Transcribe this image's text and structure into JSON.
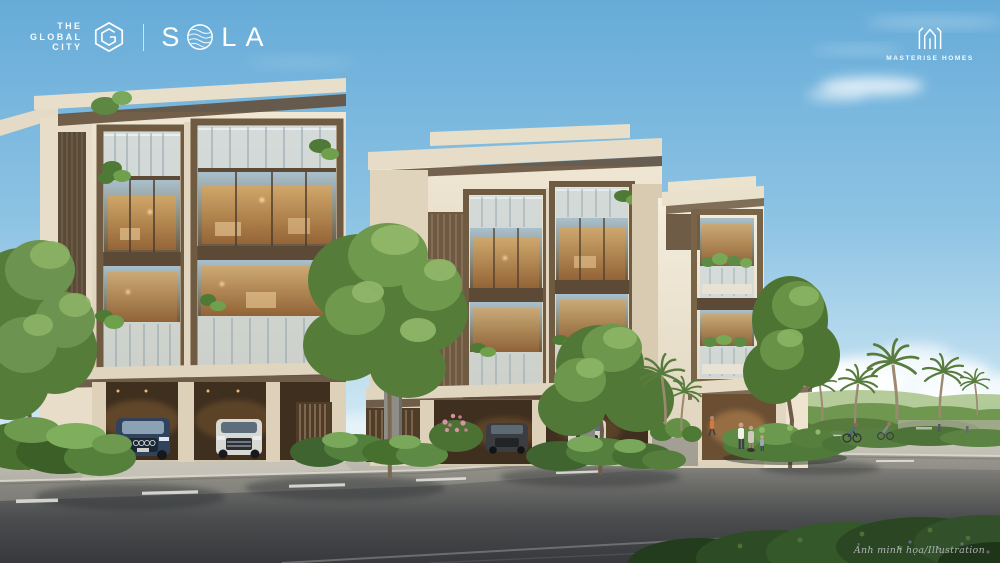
{
  "branding": {
    "global_city": {
      "line1": "THE",
      "line2": "GLOBAL",
      "line3": "CITY"
    },
    "sola": {
      "first": "S",
      "rest": "LA"
    },
    "developer": "MASTERISE HOMES"
  },
  "caption": "Ảnh minh họa/Illustration",
  "icons": {
    "global_city_hexagon": "hexagon-g-icon",
    "sola_o": "wave-circle-icon",
    "masterise_crown": "crown-m-icon"
  },
  "colors": {
    "sky_top": "#66abd8",
    "sky_horizon": "#e4f1f8",
    "facade_cream": "#e6dcc6",
    "bronze_frame": "#6f5a42",
    "glass_warm": "#c08a4e",
    "glass_cool": "#a9c0cc",
    "foliage": "#6c9150",
    "foliage_dark": "#35582b",
    "road": "#4a4c4e",
    "sidewalk": "#c0bdb2",
    "lane_yellow": "#c9b254",
    "lane_white": "#e4e4df",
    "logo_white": "#ffffff"
  }
}
